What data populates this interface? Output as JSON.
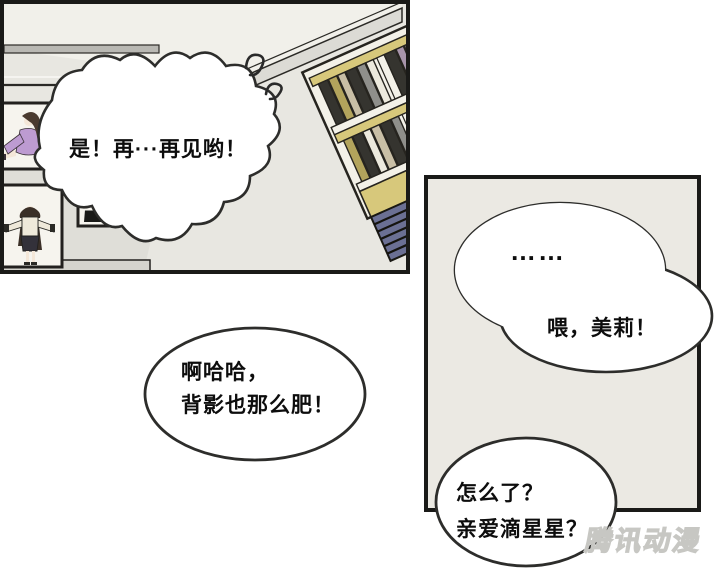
{
  "scene": {
    "type": "comic-page",
    "panel_count": 2,
    "left_panel_content": "art room with framed paintings of women and a tilted bookshelf",
    "right_panel_content": "plain grey panel with phone-call speech bubbles"
  },
  "bubbles": {
    "shout": {
      "text": "是！再···再见哟！"
    },
    "laugh": {
      "line1": "啊哈哈，",
      "line2": "背影也那么肥！"
    },
    "silence": {
      "text": "……"
    },
    "call": {
      "text": "喂，美莉！"
    },
    "reply": {
      "line1": "怎么了？",
      "line2": "亲爱滴星星？"
    }
  },
  "watermark": {
    "text": "腾讯动漫"
  },
  "colors": {
    "page_background": "#ffffff",
    "panel_border": "#1a1a18",
    "left_panel_wall": "#e8e7e1",
    "right_panel_background": "#ebe9e3",
    "bubble_fill": "#ffffff",
    "bubble_stroke": "#2d2d2b",
    "shelf_yellow": "#d7c87b",
    "cabinet_navy": "#6b7094",
    "dress_purple": "#bd9bd1",
    "jeans_blue": "#7486a6",
    "hair_brown": "#453527",
    "watermark_grey": "#c7c7c3"
  }
}
